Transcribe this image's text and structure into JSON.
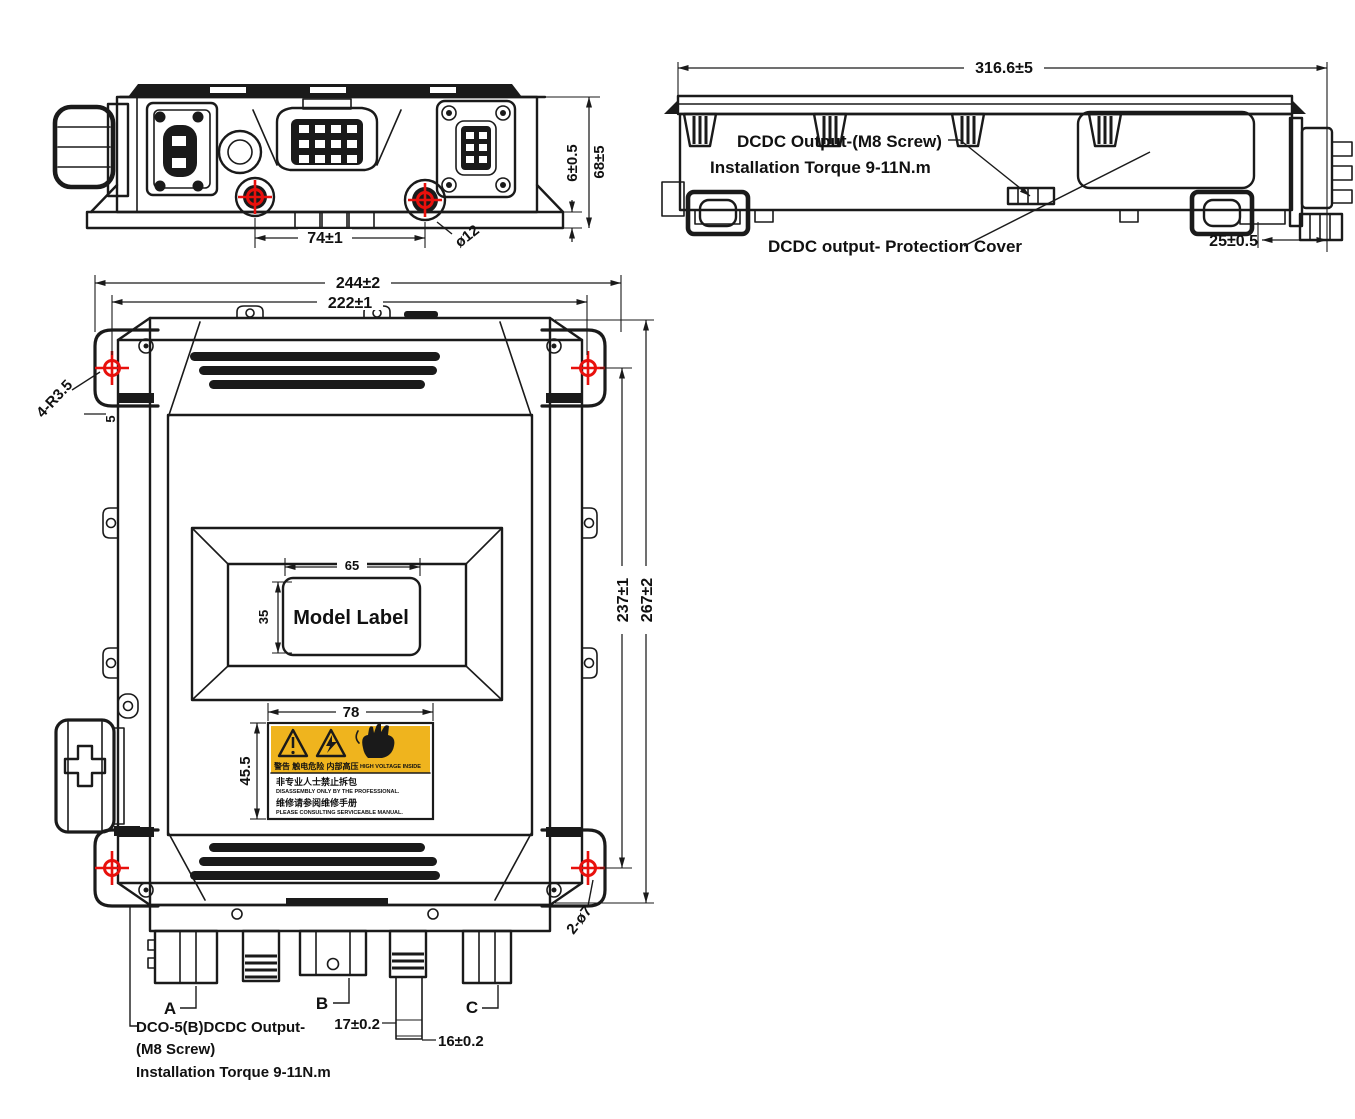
{
  "drawing_title": "DCDC converter unit dimensional drawing",
  "colors": {
    "line": "#1a1a1a",
    "crosshair_red": "#e8100c",
    "warning_yellow": "#efb41e"
  },
  "front_view": {
    "dim_74": "74±1",
    "dim_phi12": "ø12",
    "dim_6": "6±0.5",
    "dim_68": "68±5"
  },
  "side_view": {
    "dim_316": "316.6±5",
    "output_label_line1": "DCDC Output-(M8 Screw)",
    "output_label_line2": "Installation Torque 9-11N.m",
    "cover_label": "DCDC output- Protection Cover",
    "dim_25": "25±0.5"
  },
  "top_view": {
    "dim_244": "244±2",
    "dim_222": "222±1",
    "fillet_label": "4-R3.5",
    "dim_5": "5",
    "dim_65": "65",
    "dim_35": "35",
    "model_label": "Model Label",
    "dim_78": "78",
    "dim_45_5": "45.5",
    "dim_237": "237±1",
    "dim_267": "267±2",
    "holes_label": "2-ø7",
    "connector_a": "A",
    "connector_b": "B",
    "connector_c": "C",
    "dim_17": "17±0.2",
    "dim_16": "16±0.2",
    "dco_label_line1": "DCO-5(B)DCDC Output-",
    "dco_label_line2": "(M8 Screw)",
    "dco_label_line3": "Installation Torque 9-11N.m"
  },
  "warning_label": {
    "yellow_cn": "警告 触电危险 内部高压",
    "yellow_en": "HIGH VOLTAGE INSIDE",
    "white_cn1": "非专业人士禁止拆包",
    "white_en1": "DISASSEMBLY ONLY BY THE PROFESSIONAL.",
    "white_cn2": "维修请参阅维修手册",
    "white_en2": "PLEASE CONSULTING SERVICEABLE MANUAL."
  }
}
